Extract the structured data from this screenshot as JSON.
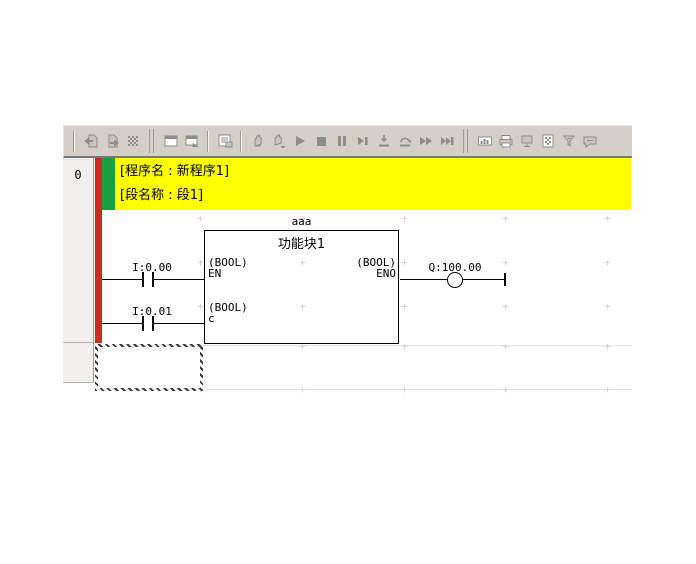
{
  "colors": {
    "toolbar_bg": "#d4d0c8",
    "bus_bar_red": "#ce2a1f",
    "rung_marker_green": "#1d9e3f",
    "header_yellow": "#ffff00",
    "grid_cross": "#d2d2d2",
    "icon_gray": "#8c8c8c"
  },
  "toolbar": {
    "groups": [
      {
        "sep": "single"
      },
      {
        "icons": [
          {
            "name": "transfer-to-plc-icon",
            "glyph": "page-up"
          },
          {
            "name": "transfer-from-plc-icon",
            "glyph": "page-down"
          },
          {
            "name": "compile-mesh-icon",
            "glyph": "mesh"
          }
        ]
      },
      {
        "sep": "double"
      },
      {
        "icons": [
          {
            "name": "simulator-window-icon",
            "glyph": "window"
          },
          {
            "name": "simulator-online-icon",
            "glyph": "window-arrow"
          }
        ]
      },
      {
        "sep": "single"
      },
      {
        "icons": [
          {
            "name": "watch-window-icon",
            "glyph": "watch"
          }
        ]
      },
      {
        "sep": "single"
      },
      {
        "icons": [
          {
            "name": "pause-hand-icon",
            "glyph": "hand"
          },
          {
            "name": "scan-pause-hand-icon",
            "glyph": "hand-scan"
          },
          {
            "name": "run-icon",
            "glyph": "play"
          },
          {
            "name": "stop-icon",
            "glyph": "stop"
          },
          {
            "name": "pause-icon",
            "glyph": "pause"
          },
          {
            "name": "step-run-icon",
            "glyph": "step-next"
          },
          {
            "name": "step-in-icon",
            "glyph": "step-in"
          },
          {
            "name": "step-over-icon",
            "glyph": "step-over"
          },
          {
            "name": "continuous-step-icon",
            "glyph": "ffwd"
          },
          {
            "name": "scan-run-icon",
            "glyph": "to-end"
          }
        ]
      },
      {
        "sep": "double"
      },
      {
        "icons": [
          {
            "name": "gauge-window-icon",
            "glyph": "io-bar"
          },
          {
            "name": "plc-print-icon",
            "glyph": "plc-print"
          },
          {
            "name": "monitor-display-icon",
            "glyph": "monitor"
          },
          {
            "name": "pattern-page-icon",
            "glyph": "pattern-page"
          },
          {
            "name": "filter-funnel-icon",
            "glyph": "funnel"
          },
          {
            "name": "comment-bubble-icon",
            "glyph": "bubble"
          }
        ]
      }
    ]
  },
  "ladder": {
    "rung_number": "0",
    "header": {
      "line1": "[程序名 : 新程序1]",
      "line2": "[段名称 : 段1]"
    },
    "contacts": [
      {
        "label": "I:0.00"
      },
      {
        "label": "I:0.01"
      }
    ],
    "function_block": {
      "instance_name": "aaa",
      "title": "功能块1",
      "inputs": [
        {
          "type": "(BOOL)",
          "name": "EN"
        },
        {
          "type": "(BOOL)",
          "name": "c"
        }
      ],
      "outputs": [
        {
          "type": "(BOOL)",
          "name": "ENO"
        }
      ]
    },
    "coil": {
      "label": "Q:100.00"
    },
    "grid": {
      "xs": [
        200,
        302,
        404,
        505,
        607
      ],
      "ys": [
        218,
        262,
        306,
        346,
        389
      ],
      "row_lines_y": [
        345,
        389
      ]
    }
  }
}
